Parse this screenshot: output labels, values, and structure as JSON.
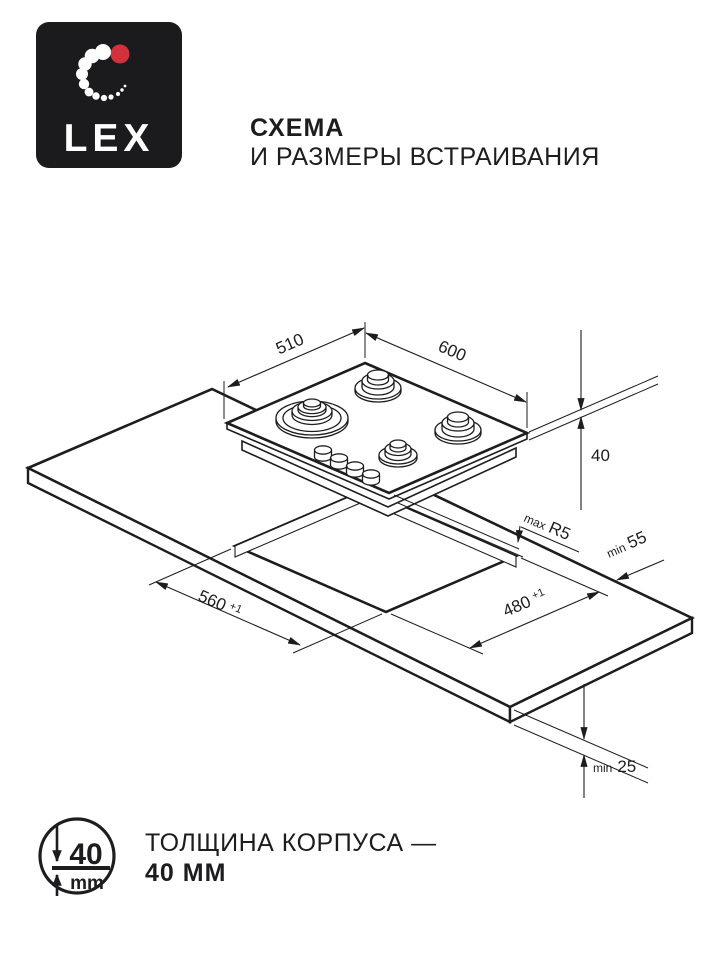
{
  "header": {
    "brand": "LEX",
    "title_bold": "СХЕМА",
    "title_rest": "И РАЗМЕРЫ ВСТРАИВАНИЯ"
  },
  "dims": {
    "width": "510",
    "length": "600",
    "height": "40",
    "radius_prefix": "max",
    "radius": "R5",
    "side_prefix": "min",
    "side": "55",
    "cutout_width": "560",
    "cutout_width_tol": "+1",
    "cutout_depth": "480",
    "cutout_depth_tol": "+1",
    "thickness_prefix": "min",
    "thickness": "25"
  },
  "footer": {
    "icon_value": "40",
    "icon_unit": "mm",
    "note_line1": "ТОЛЩИНА КОРПУСА —",
    "note_line2": "40 ММ"
  },
  "colors": {
    "ink": "#1d1d1f",
    "accent_red": "#d2323e",
    "logo_bg": "#1b1b1d"
  }
}
